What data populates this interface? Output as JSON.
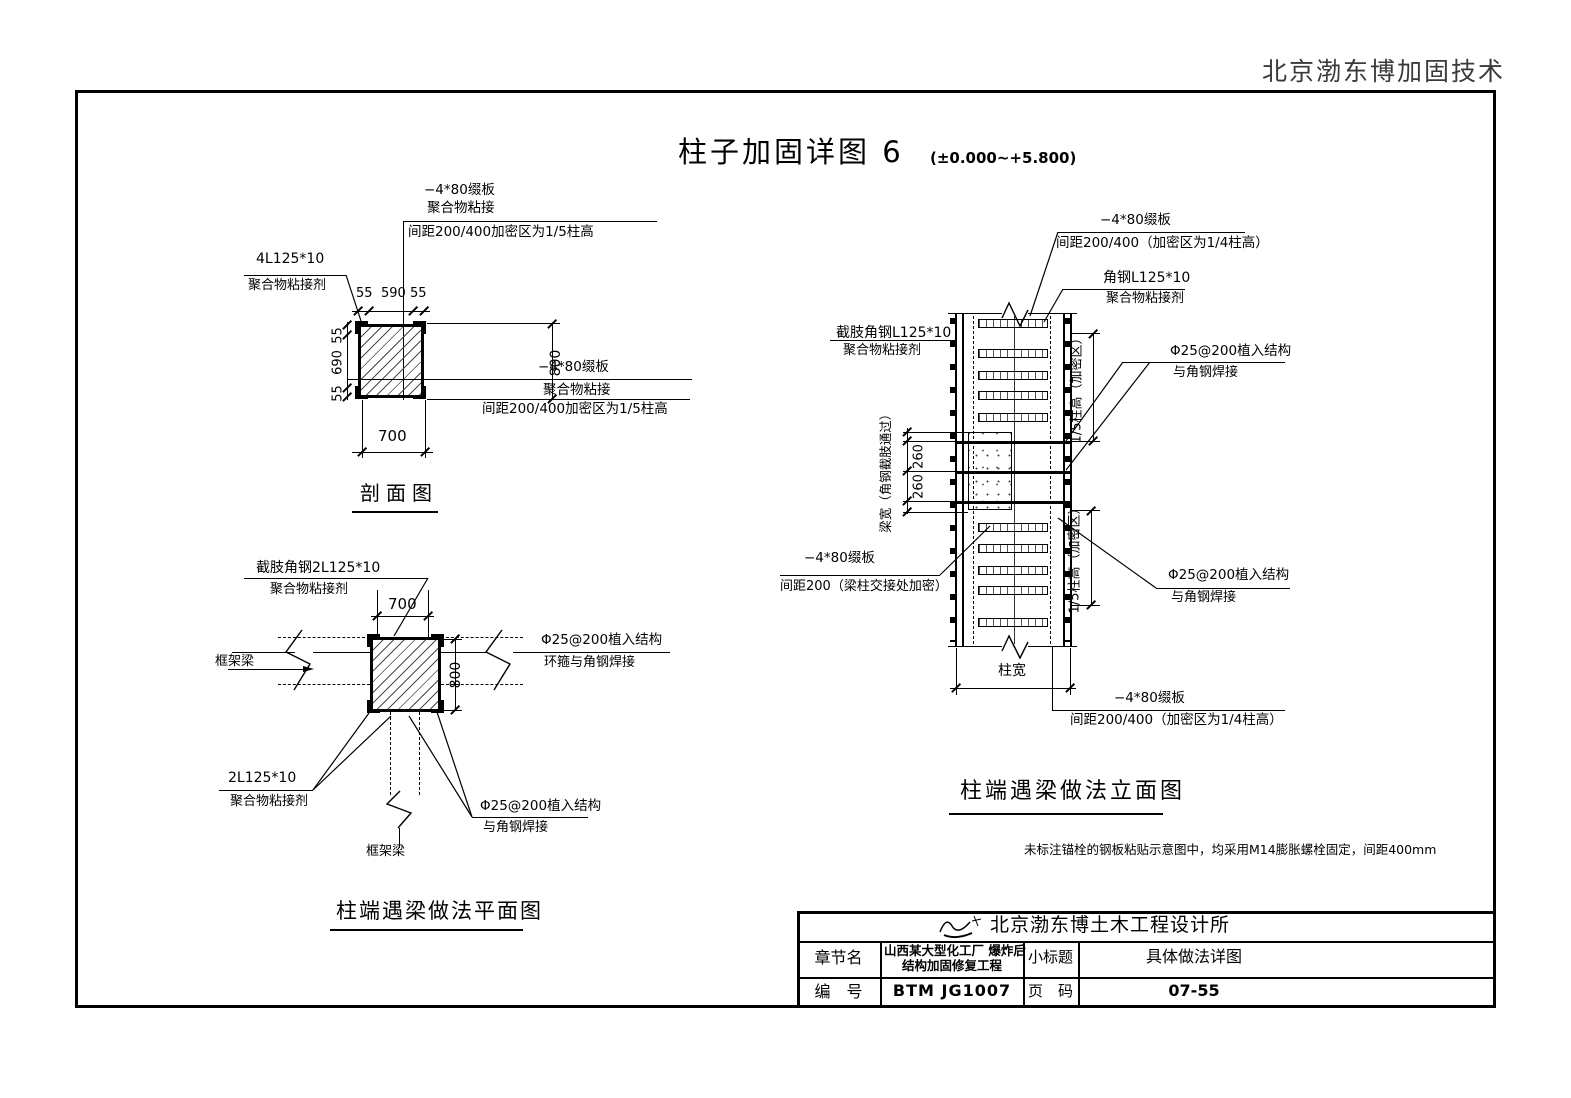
{
  "header": {
    "brand": "北京渤东博加固技术"
  },
  "title": {
    "main": "柱子加固详图 6",
    "range": "(±0.000~+5.800)"
  },
  "section": {
    "caption": "剖面图",
    "top_note1": "−4*80缀板",
    "top_note2": "聚合物粘接",
    "top_note3": "间距200/400加密区为1/5柱高",
    "left_note1": "4L125*10",
    "left_note2": "聚合物粘接剂",
    "right_note1": "−4*80缀板",
    "right_note2": "聚合物粘接",
    "right_note3": "间距200/400加密区为1/5柱高",
    "dim_top_left": "55",
    "dim_top_mid": "590",
    "dim_top_right": "55",
    "dim_left_top": "55",
    "dim_left_mid": "690",
    "dim_left_bottom": "55",
    "dim_right": "800",
    "dim_bottom": "700"
  },
  "plan": {
    "caption": "柱端遇梁做法平面图",
    "top_note1": "截肢角钢2L125*10",
    "top_note2": "聚合物粘接剂",
    "beam_left": "框架梁",
    "beam_bottom": "框架梁",
    "right_note1": "Φ25@200植入结构",
    "right_note2": "环箍与角钢焊接",
    "bl_note1": "2L125*10",
    "bl_note2": "聚合物粘接剂",
    "br_note1": "Φ25@200植入结构",
    "br_note2": "与角钢焊接",
    "dim_top": "700",
    "dim_right": "800"
  },
  "elevation": {
    "caption": "柱端遇梁做法立面图",
    "note": "未标注锚栓的钢板粘贴示意图中，均采用M14膨胀螺栓固定，间距400mm",
    "top_note1": "−4*80缀板",
    "top_note2": "间距200/400（加密区为1/4柱高）",
    "angle_note1": "角钢L125*10",
    "angle_note2": "聚合物粘接剂",
    "left_top_note1": "截肢角钢L125*10",
    "left_top_note2": "聚合物粘接剂",
    "right_top_note1": "Φ25@200植入结构",
    "right_top_note2": "与角钢焊接",
    "left_bottom_note1": "−4*80缀板",
    "left_bottom_note2": "间距200（梁柱交接处加密）",
    "right_bottom_note1": "Φ25@200植入结构",
    "right_bottom_note2": "与角钢焊接",
    "bottom_note1": "−4*80缀板",
    "bottom_note2": "间距200/400（加密区为1/4柱高）",
    "dim_260a": "260",
    "dim_260b": "260",
    "dim_beam_width": "梁宽（角钢截肢通过）",
    "dim_top_right": "1/5柱高（加密区）",
    "dim_bottom_right": "1/5柱高（加密区）",
    "dim_col_width": "柱宽"
  },
  "title_block": {
    "company": "北京渤东博土木工程设计所",
    "row1_label1": "章节名",
    "row1_value1a": "山西某大型化工厂 爆炸后",
    "row1_value1b": "结构加固修复工程",
    "row1_label2": "小标题",
    "row1_value2": "具体做法详图",
    "row2_label1": "编　号",
    "row2_value1": "BTM JG1007",
    "row2_label2": "页　码",
    "row2_value2": "07-55"
  }
}
